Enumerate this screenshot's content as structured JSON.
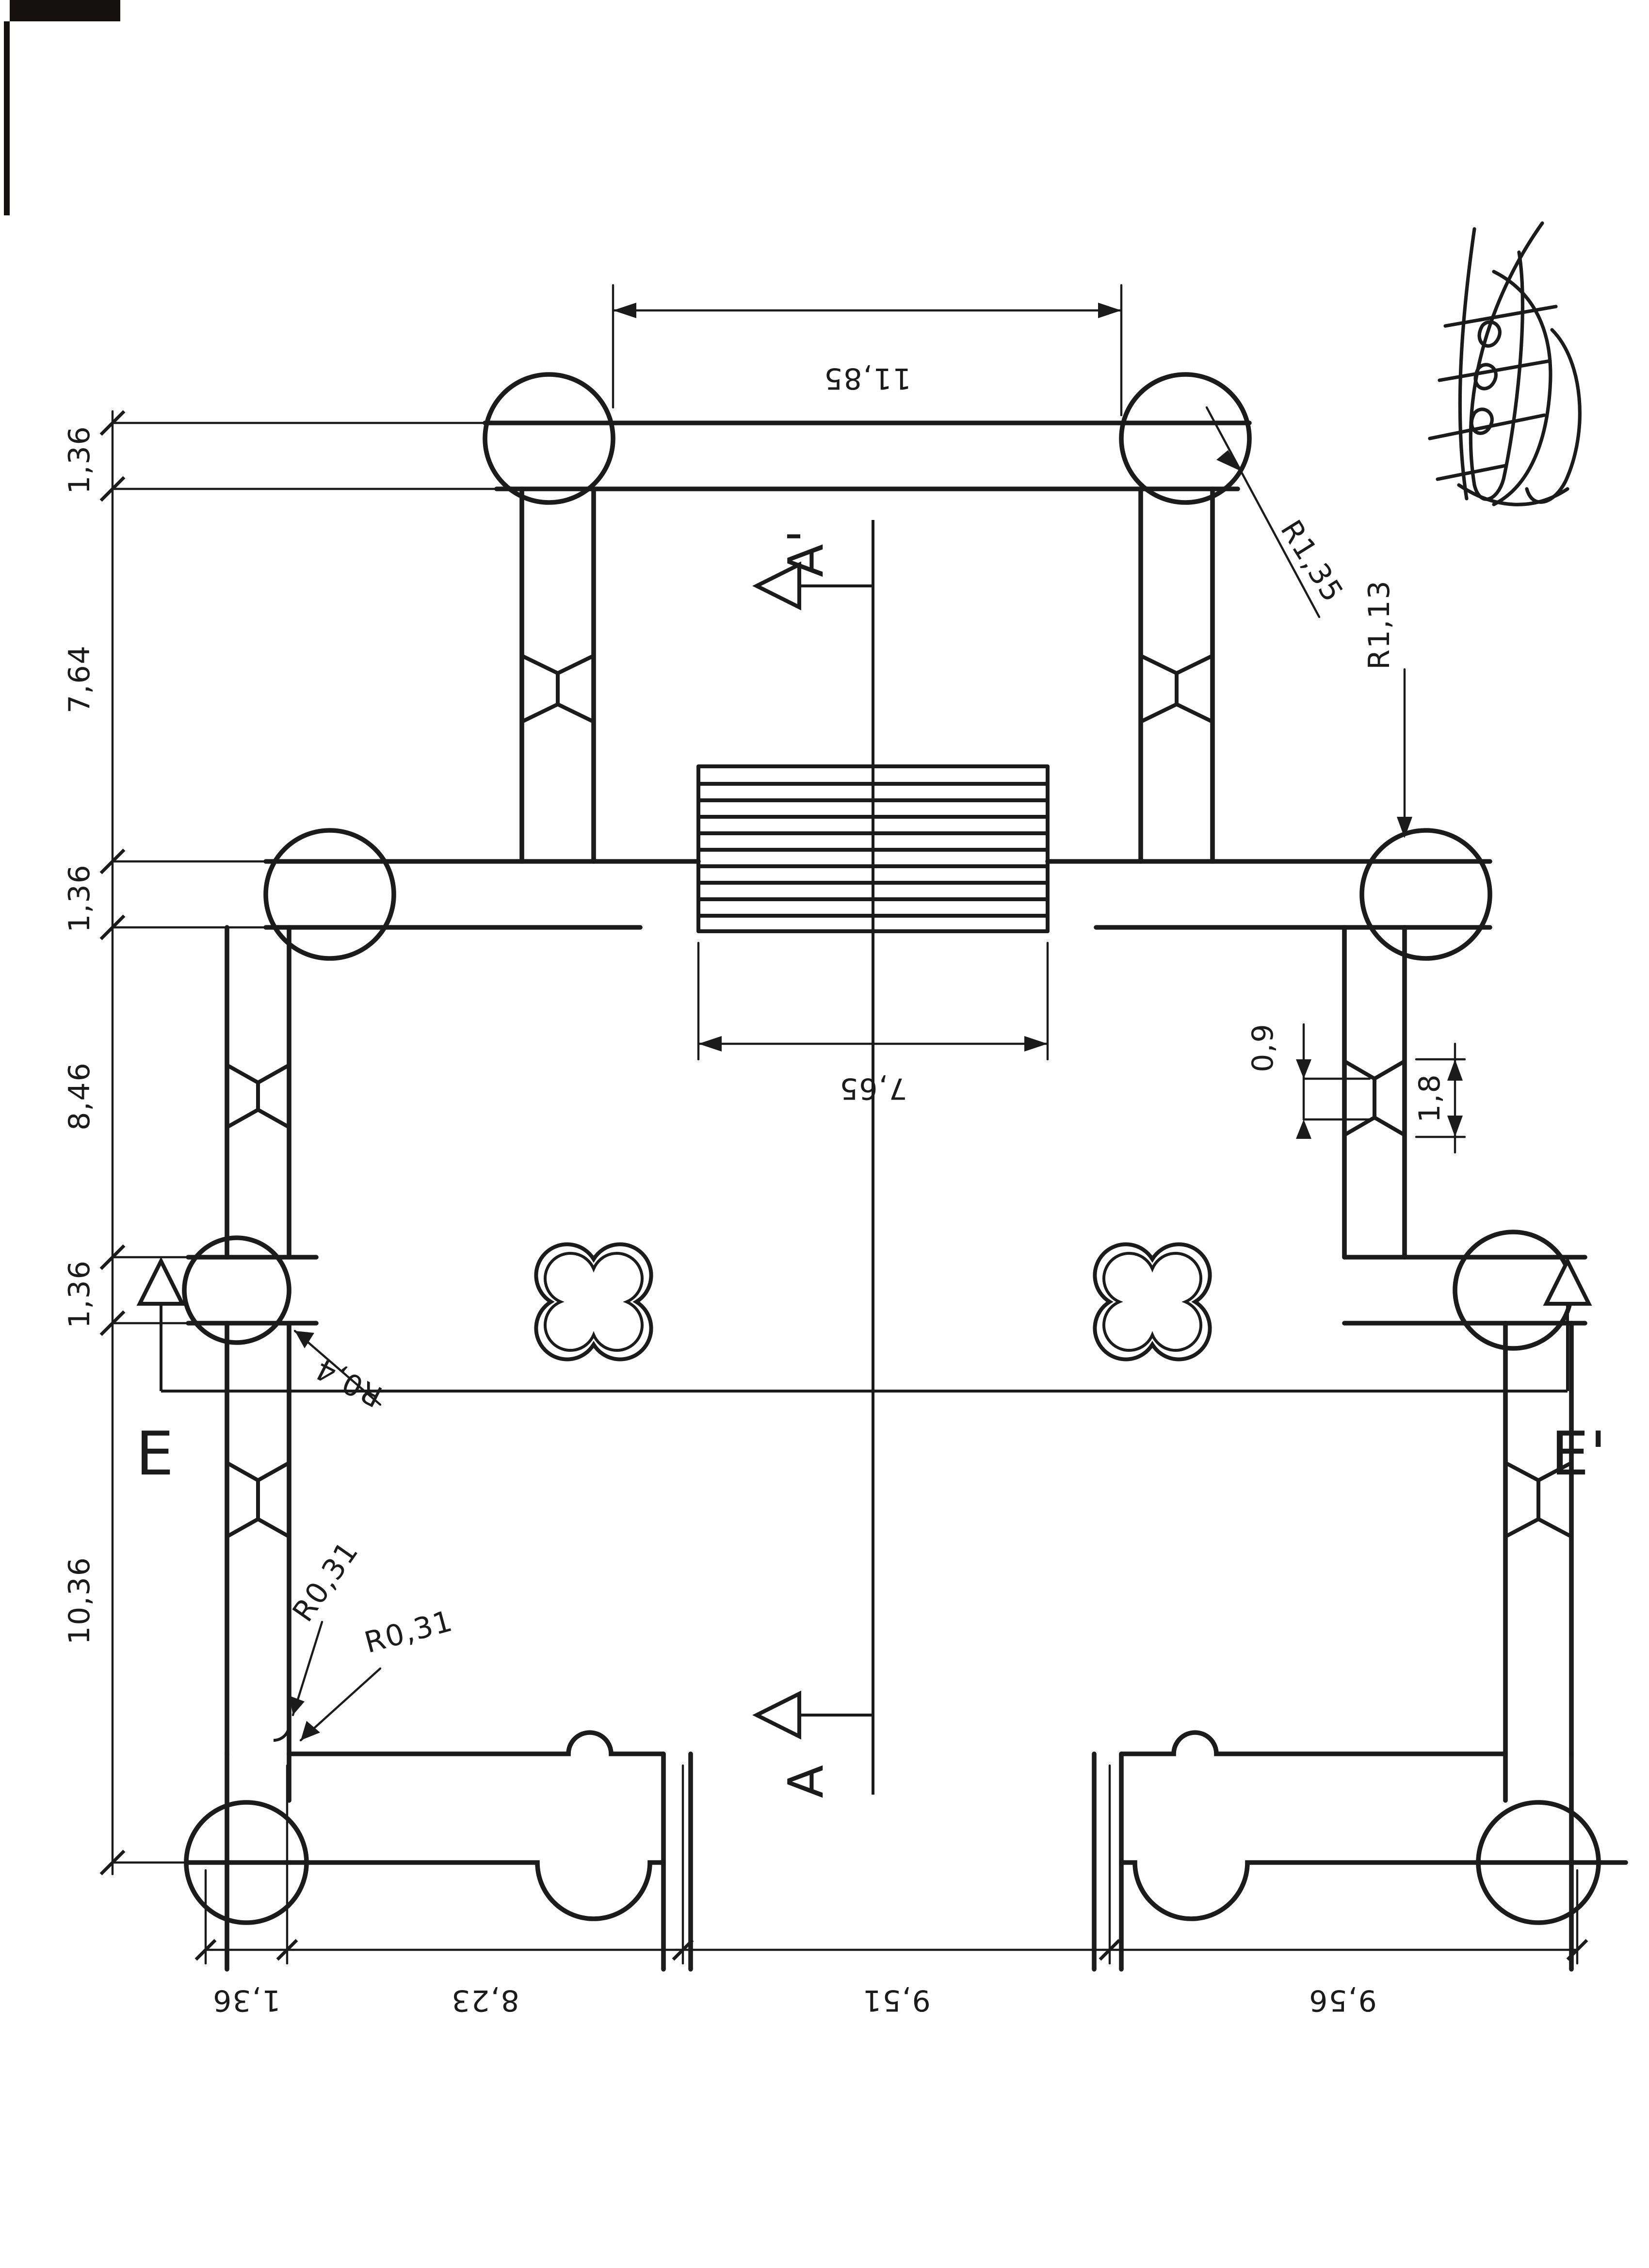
{
  "document": {
    "type": "scanned architectural floor plan",
    "orientation": "plan rotated; dimension texts read sideways / upside down"
  },
  "annotations": {
    "dim_top": "11,85",
    "left_chain": [
      "1,36",
      "7,64",
      "1,36",
      "8,46",
      "1,36",
      "10,36"
    ],
    "bottom_chain": [
      "1,36",
      "8,23",
      "9,51",
      "9,56"
    ],
    "stairs_width": "7,65",
    "radii": {
      "r135": "R1,35",
      "r113": "R1,13",
      "r04": "R0,4",
      "r031a": "R0,31",
      "r031b": "R0,31"
    },
    "joint": {
      "waist": "0,9",
      "height": "1,8"
    },
    "sections": {
      "a": "A",
      "a_prime": "A'",
      "e": "E",
      "e_prime": "E'"
    }
  },
  "colors": {
    "ink": "#1b1b1b",
    "paper": "#ffffff",
    "scan_artifact": "#151111"
  }
}
